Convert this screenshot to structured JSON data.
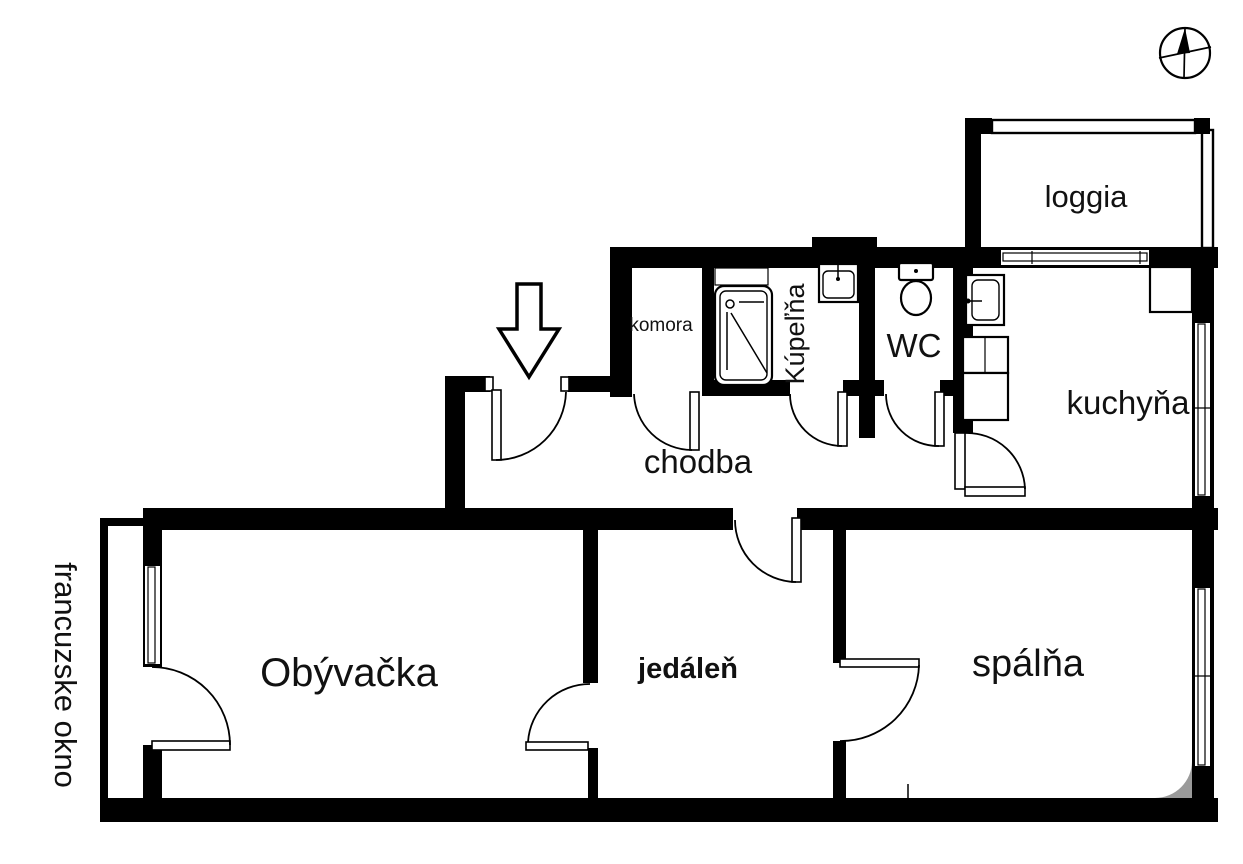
{
  "plan": {
    "kind": "apartment-floor-plan",
    "rooms": {
      "loggia": {
        "label": "loggia"
      },
      "komora": {
        "label": "komora"
      },
      "kupelna": {
        "label": "Kúpeľňa"
      },
      "wc": {
        "label": "WC"
      },
      "kuchyna": {
        "label": "kuchyňa"
      },
      "chodba": {
        "label": "chodba"
      },
      "obyvacka": {
        "label": "Obývačka"
      },
      "jedalen": {
        "label": "jedáleň"
      },
      "spalna": {
        "label": "spálňa"
      }
    },
    "annotations": {
      "french_window": {
        "label": "francuzske okno"
      }
    },
    "symbols": {
      "compass": "compass-north-icon",
      "entrance": "entrance-arrow-down-icon",
      "fixtures": [
        "bathtub-shower",
        "washbasin",
        "toilet",
        "kitchen-sink",
        "kitchen-counter",
        "refrigerator"
      ]
    },
    "colors": {
      "walls": "#000000",
      "background": "#ffffff",
      "corner_fillet": "#9a9a9a"
    }
  }
}
